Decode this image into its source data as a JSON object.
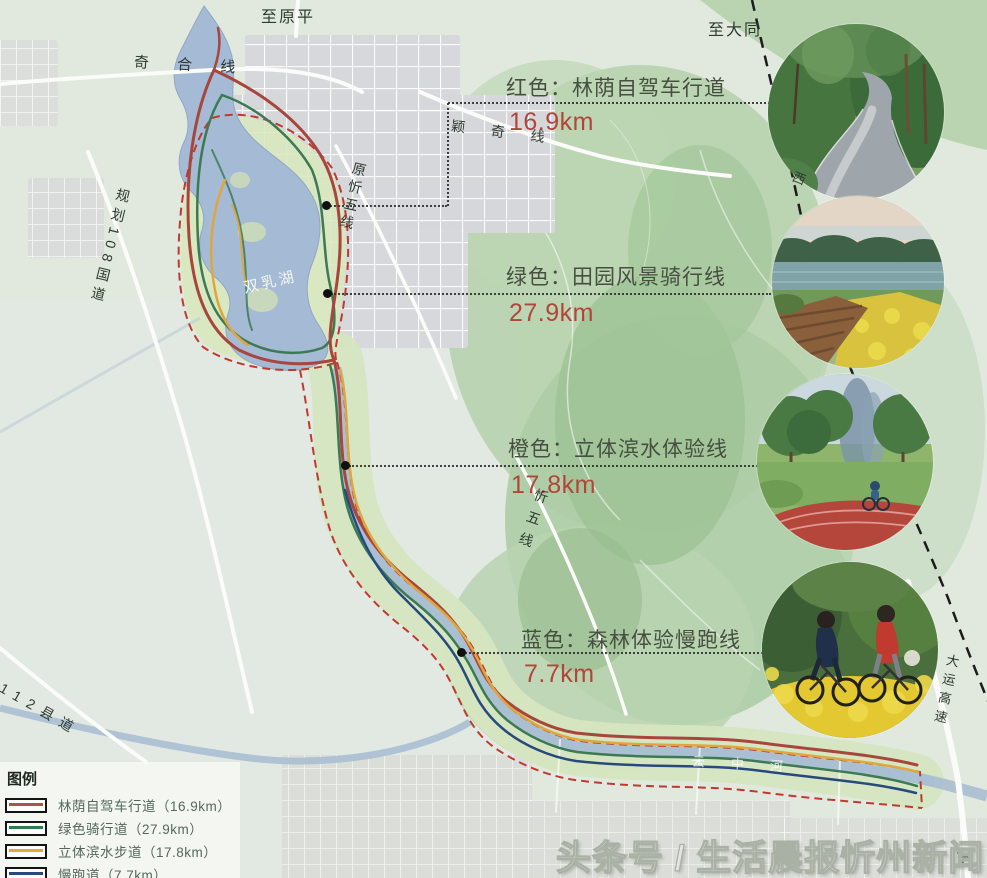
{
  "callouts": [
    {
      "title": "红色：林荫自驾车行道",
      "distance": "16.9km"
    },
    {
      "title": "绿色：田园风景骑行线",
      "distance": "27.9km"
    },
    {
      "title": "橙色：立体滨水体验线",
      "distance": "17.8km"
    },
    {
      "title": "蓝色：森林体验慢跑线",
      "distance": "7.7km"
    }
  ],
  "legend": {
    "title": "图例",
    "items": [
      {
        "label": "林荫自驾车行道（16.9km）",
        "color": "#b0524c"
      },
      {
        "label": "绿色骑行道（27.9km）",
        "color": "#2e7d4f"
      },
      {
        "label": "立体滨水步道（17.8km）",
        "color": "#e2a93b"
      },
      {
        "label": "慢跑道（7.7km）",
        "color": "#27497c"
      }
    ]
  },
  "map_labels": {
    "to_yuanping": "至原平",
    "to_datong": "至大同",
    "qihe_line": "奇 合 线",
    "g108": "规划108国道",
    "yuanxinwu_line": "原忻五线",
    "yingqi_line": "颖 奇 线",
    "xinwu_line": "忻五线",
    "lake": "双乳湖",
    "river": "云中河",
    "county_112": "112县道",
    "dayun_expressway": "大运高速",
    "west_char": "西",
    "to_bottom_right": "至"
  },
  "watermark": "头条号 / 生活晨报忻州新闻",
  "route_colors": {
    "driving_red": "#a6463c",
    "cycling_green": "#3c7a54",
    "waterfront_orange": "#dfa63e",
    "jogging_blue": "#27497c",
    "boundary_dashed_red": "#bf3a2e"
  }
}
